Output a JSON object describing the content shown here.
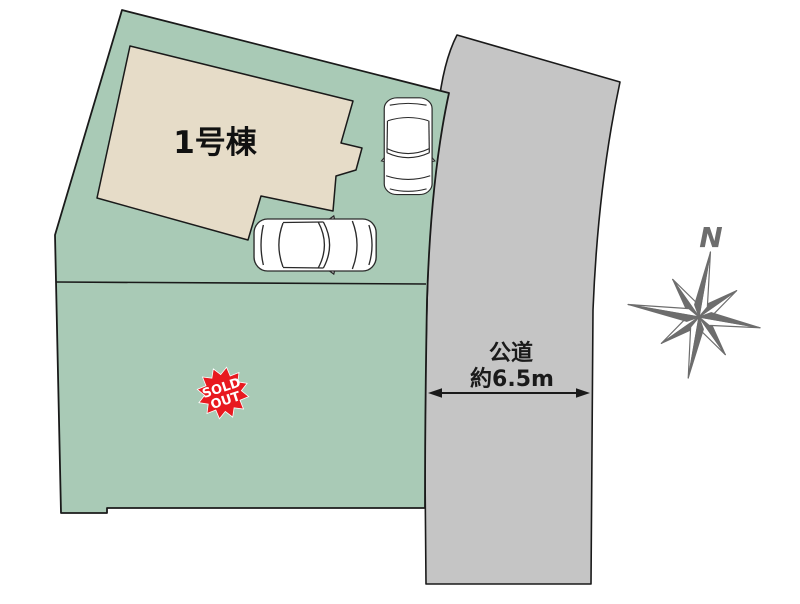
{
  "plot": {
    "building": {
      "label": "1号棟"
    },
    "sold_out_badge": {
      "line1": "SOLD",
      "line2": "OUT"
    }
  },
  "road": {
    "name": "公道",
    "width_label": "約6.5m"
  },
  "compass": {
    "north": "N"
  },
  "colors": {
    "plot_green": "#a9cab6",
    "building_beige": "#e6dcc8",
    "road_gray": "#c5c5c5",
    "badge_red": "#e8191f",
    "badge_text": "#ffffff",
    "compass_gray": "#6d6d6d",
    "outline": "#1a1a1a"
  }
}
